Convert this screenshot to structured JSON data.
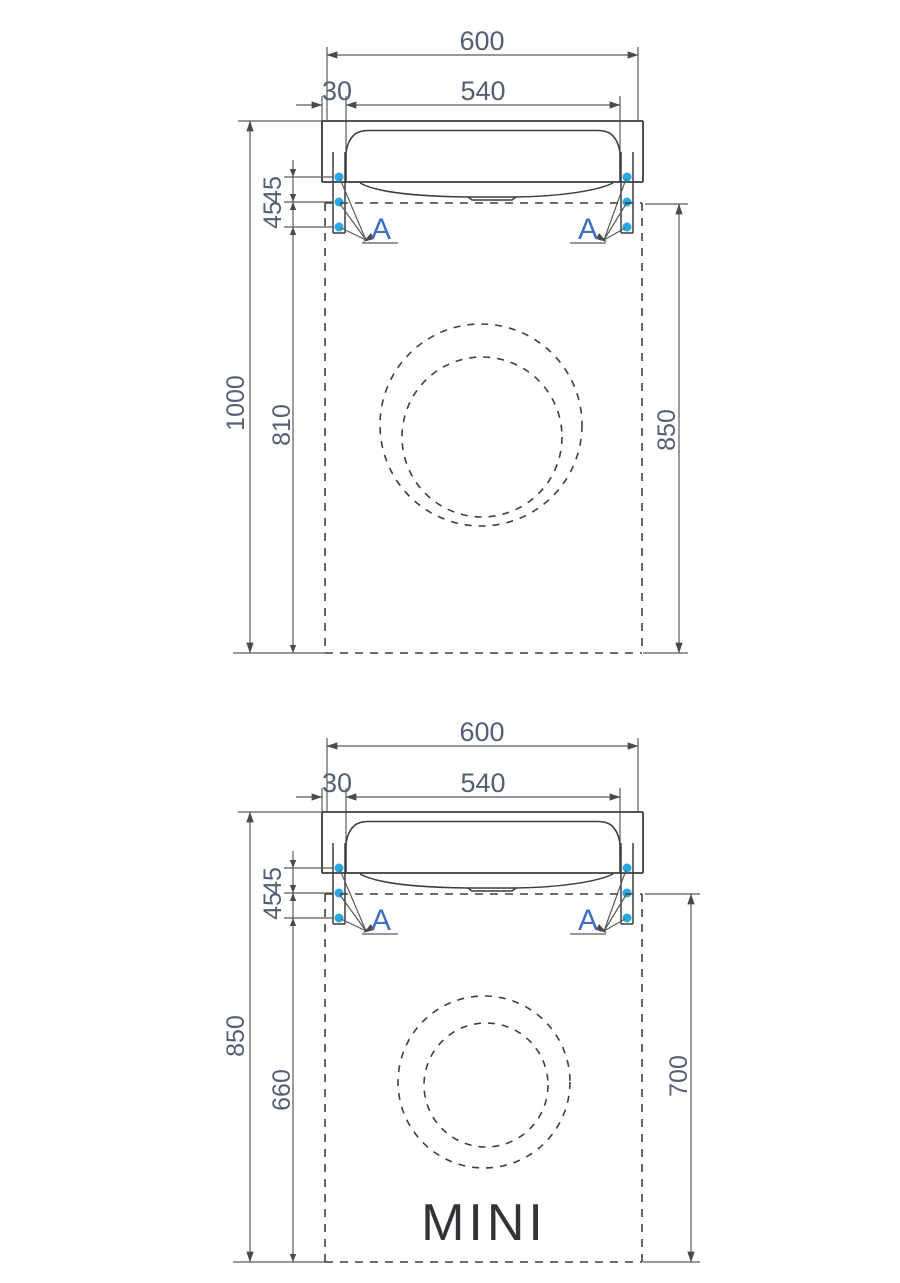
{
  "colors": {
    "line": "#3c3c3c",
    "dimension_line": "#5a5a5a",
    "dimension_text": "#545f73",
    "detail_label": "#3f6fc0",
    "mounting_dot": "#29a9e2",
    "background": "#ffffff"
  },
  "top_drawing": {
    "total_width": "600",
    "hole_spacing": "540",
    "hole_offset": "30",
    "hole_gap_1": "45",
    "hole_gap_2": "45",
    "overall_height": "1000",
    "bracket_to_floor": "810",
    "machine_height": "850",
    "detail_left": "A",
    "detail_right": "A"
  },
  "bottom_drawing": {
    "total_width": "600",
    "hole_spacing": "540",
    "hole_offset": "30",
    "hole_gap_1": "45",
    "hole_gap_2": "45",
    "overall_height": "850",
    "bracket_to_floor": "660",
    "machine_height": "700",
    "detail_left": "A",
    "detail_right": "A",
    "variant_label": "MINI"
  }
}
